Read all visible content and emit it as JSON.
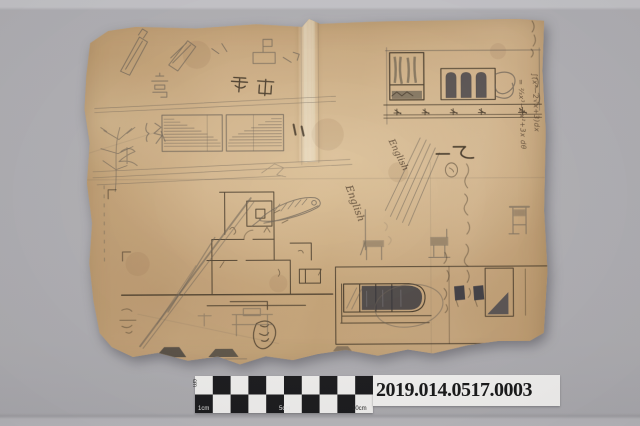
{
  "photo": {
    "subject": "aged sketch paper with pencil and ink drawings",
    "colors": {
      "background": "#b1b0b4",
      "paper": "#c9a87c",
      "pencil": "#6a6054",
      "ink": "#33281a",
      "dark_wash": "#2e2f38",
      "label_bg": "#f6f5f3",
      "checker_dark": "#161618",
      "checker_light": "#f4f3f1"
    }
  },
  "catalog_label": {
    "number": "2019.014.0517.0003"
  },
  "scale_bar": {
    "unit_label": "cm",
    "tick_labels": {
      "t1": "1cm",
      "t5": "5cm",
      "t10": "10cm"
    },
    "columns": 10,
    "rows": 2
  },
  "handwriting": {
    "char_high": "高",
    "char_grade": "級",
    "inverted_caption": "側面",
    "ink_mark": "乙二",
    "cursive_1": "English",
    "cursive_2": "English",
    "formula_right_1": "∫(x²−2√x+3)dx",
    "formula_right_2": "= ⅔x³−2x²+3x dθ",
    "formula_left": "∫(x²+2x+3)dx"
  }
}
